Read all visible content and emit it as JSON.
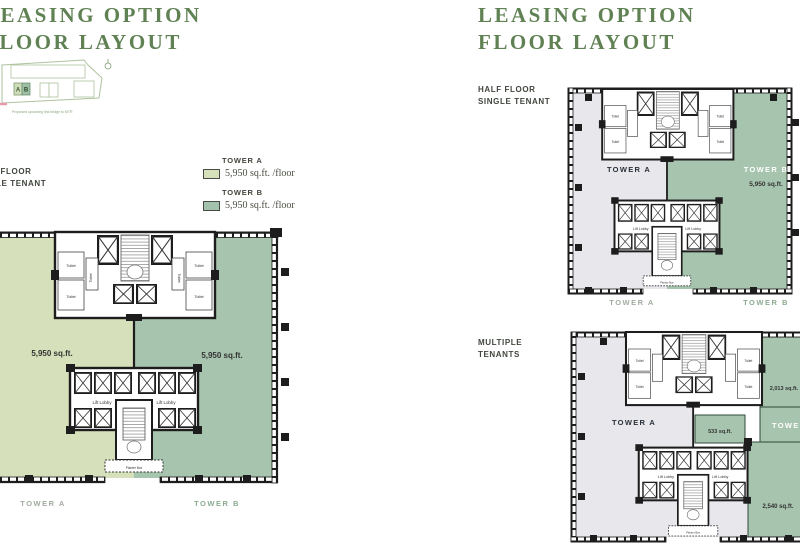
{
  "colors": {
    "title_green": "#5f8153",
    "light_green": "#d6e0ba",
    "sage_green": "#a7c4ae",
    "tower_a_gray": "#e7e7ec",
    "plan_line": "#1d1d1d",
    "caption_gray": "#a2aca0",
    "caption_green": "#8cab91",
    "site_pink": "#e799ac"
  },
  "shared": {
    "toilet": "Toilet",
    "lift_lobby": "Lift Lobby",
    "planter_box": "Planter Box"
  },
  "left_page": {
    "title_line1": "LEASING OPTION",
    "title_line2": "FLOOR LAYOUT",
    "site_plan": {
      "block_a": "A",
      "block_b": "B",
      "caption": "Proposed upcoming link bridge to MTR"
    },
    "section_label_line1": "HALF FLOOR",
    "section_label_line2": "SINGLE TENANT",
    "legend": {
      "tower_a_name": "TOWER A",
      "tower_a_value": "5,950 sq.ft. /floor",
      "tower_b_name": "TOWER B",
      "tower_b_value": "5,950 sq.ft. /floor"
    },
    "plan": {
      "tower_a_area": "5,950 sq.ft.",
      "tower_b_area": "5,950 sq.ft.",
      "tower_a_caption": "TOWER A",
      "tower_b_caption": "TOWER B"
    }
  },
  "right_page": {
    "title_line1": "LEASING OPTION",
    "title_line2": "FLOOR LAYOUT",
    "half_floor": {
      "label_line1": "HALF FLOOR",
      "label_line2": "SINGLE TENANT",
      "tower_a_label": "TOWER A",
      "tower_b_label": "TOWER B",
      "tower_b_area": "5,950 sq.ft.",
      "tower_a_caption": "TOWER A",
      "tower_b_caption": "TOWER B"
    },
    "multi": {
      "label_line1": "MULTIPLE",
      "label_line2": "TENANTS",
      "tower_a_label": "TOWER A",
      "tower_b_label": "TOWER B",
      "unit_top_area": "2,013 sq.ft.",
      "unit_mid_area": "533 sq.ft.",
      "unit_bottom_area": "2,540 sq.ft."
    }
  }
}
